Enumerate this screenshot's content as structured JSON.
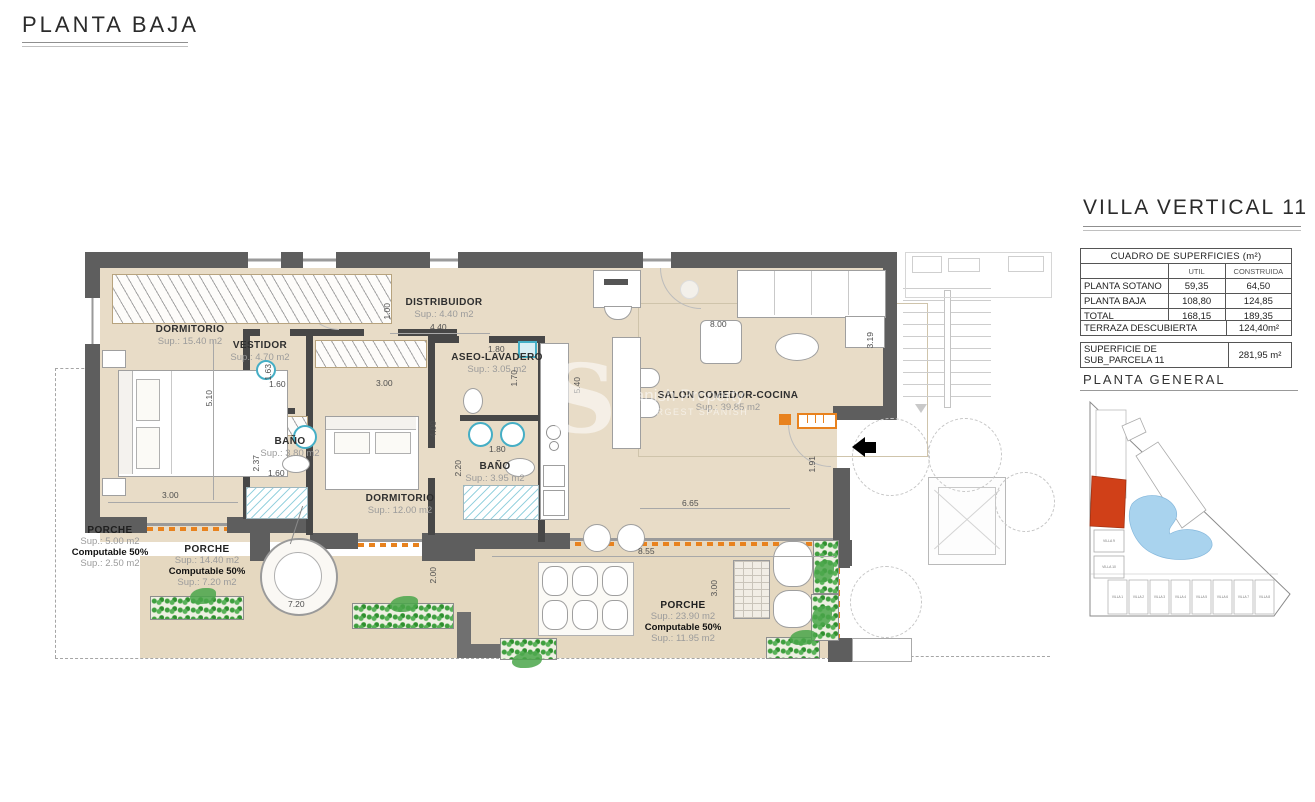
{
  "page": {
    "title": "PLANTA BAJA"
  },
  "panel": {
    "title": "VILLA VERTICAL 11",
    "surface_table": {
      "title": "CUADRO DE SUPERFICIES (m²)",
      "columns": {
        "util": "UTIL",
        "construida": "CONSTRUIDA"
      },
      "rows": [
        {
          "name": "PLANTA SOTANO",
          "util": "59,35",
          "construida": "64,50"
        },
        {
          "name": "PLANTA BAJA",
          "util": "108,80",
          "construida": "124,85"
        },
        {
          "name": "TOTAL",
          "util": "168,15",
          "construida": "189,35"
        }
      ],
      "terraza": {
        "label": "TERRAZA DESCUBIERTA",
        "value": "124,40m²"
      },
      "parcela": {
        "label": "SUPERFICIE DE SUB_PARCELA 11",
        "value": "281,95 m²"
      }
    },
    "site_plan": {
      "title": "PLANTA GENERAL",
      "highlight_color": "#d04018",
      "pool_color": "#a9d3ee",
      "villas_bottom": [
        "VILLA 1",
        "VILLA 2",
        "VILLA 3",
        "VILLA 4",
        "VILLA 5",
        "VILLA 6",
        "VILLA 7",
        "VILLA 8"
      ],
      "villas_left": [
        "VILLA 9",
        "VILLA 10"
      ]
    }
  },
  "plan": {
    "colors": {
      "wall": "#5e5e5e",
      "floor": "#e8dcc7",
      "accent_orange": "#e8821e",
      "fixture_teal": "#45aec5",
      "plant_green": "#4aa64a"
    },
    "rooms": [
      {
        "name": "DORMITORIO",
        "sup": "Sup.: 15.40  m2"
      },
      {
        "name": "VESTIDOR",
        "sup": "Sup.: 4.70  m2"
      },
      {
        "name": "BAÑO",
        "sup": "Sup.: 3.80  m2"
      },
      {
        "name": "DISTRIBUIDOR",
        "sup": "Sup.: 4.40  m2"
      },
      {
        "name": "ASEO-LAVADERO",
        "sup": "Sup.: 3.05  m2"
      },
      {
        "name": "DORMITORIO",
        "sup": "Sup.: 12.00  m2"
      },
      {
        "name": "BAÑO",
        "sup": "Sup.: 3.95  m2"
      },
      {
        "name": "SALON COMEDOR-COCINA",
        "sup": "Sup.: 39.85  m2"
      }
    ],
    "porches": [
      {
        "name": "PORCHE",
        "sup": "Sup.: 5.00  m2",
        "computable": "Computable 50%",
        "sup2": "Sup.: 2.50  m2"
      },
      {
        "name": "PORCHE",
        "sup": "Sup.: 14.40 m2",
        "computable": "Computable 50%",
        "sup2": "Sup.: 7.20  m2"
      },
      {
        "name": "PORCHE",
        "sup": "Sup.: 23.90 m2",
        "computable": "Computable 50%",
        "sup2": "Sup.: 11.95 m2"
      }
    ],
    "dims": {
      "bedroom1_height": "5.10",
      "bedroom1_width": "3.00",
      "bath1_height": "2.37",
      "bath1_width": "1.60",
      "vestidor_height": "1.63",
      "vestidor_width": "1.60",
      "hall_height": "1.00",
      "hall_width": "4.40",
      "closet2_width": "3.00",
      "bedroom2_height": "4.00",
      "aseo_width": "1.80",
      "aseo_height": "1.70",
      "bath2_width": "1.80",
      "bath2_height": "2.20",
      "kitchen_height": "5.40",
      "salon_width": "8.00",
      "salon_right_height": "3.19",
      "entrance_height": "1.91",
      "salon_bottom_width": "6.65",
      "terrace_width": "8.55",
      "terrace_depth": "2.00",
      "porch_mid_width": "7.20",
      "porch_right_depth": "3.00"
    }
  },
  "watermark": {
    "letter": "S",
    "line1": "Spanish Property",
    "line2": "THE LARGEST SPANISH"
  }
}
